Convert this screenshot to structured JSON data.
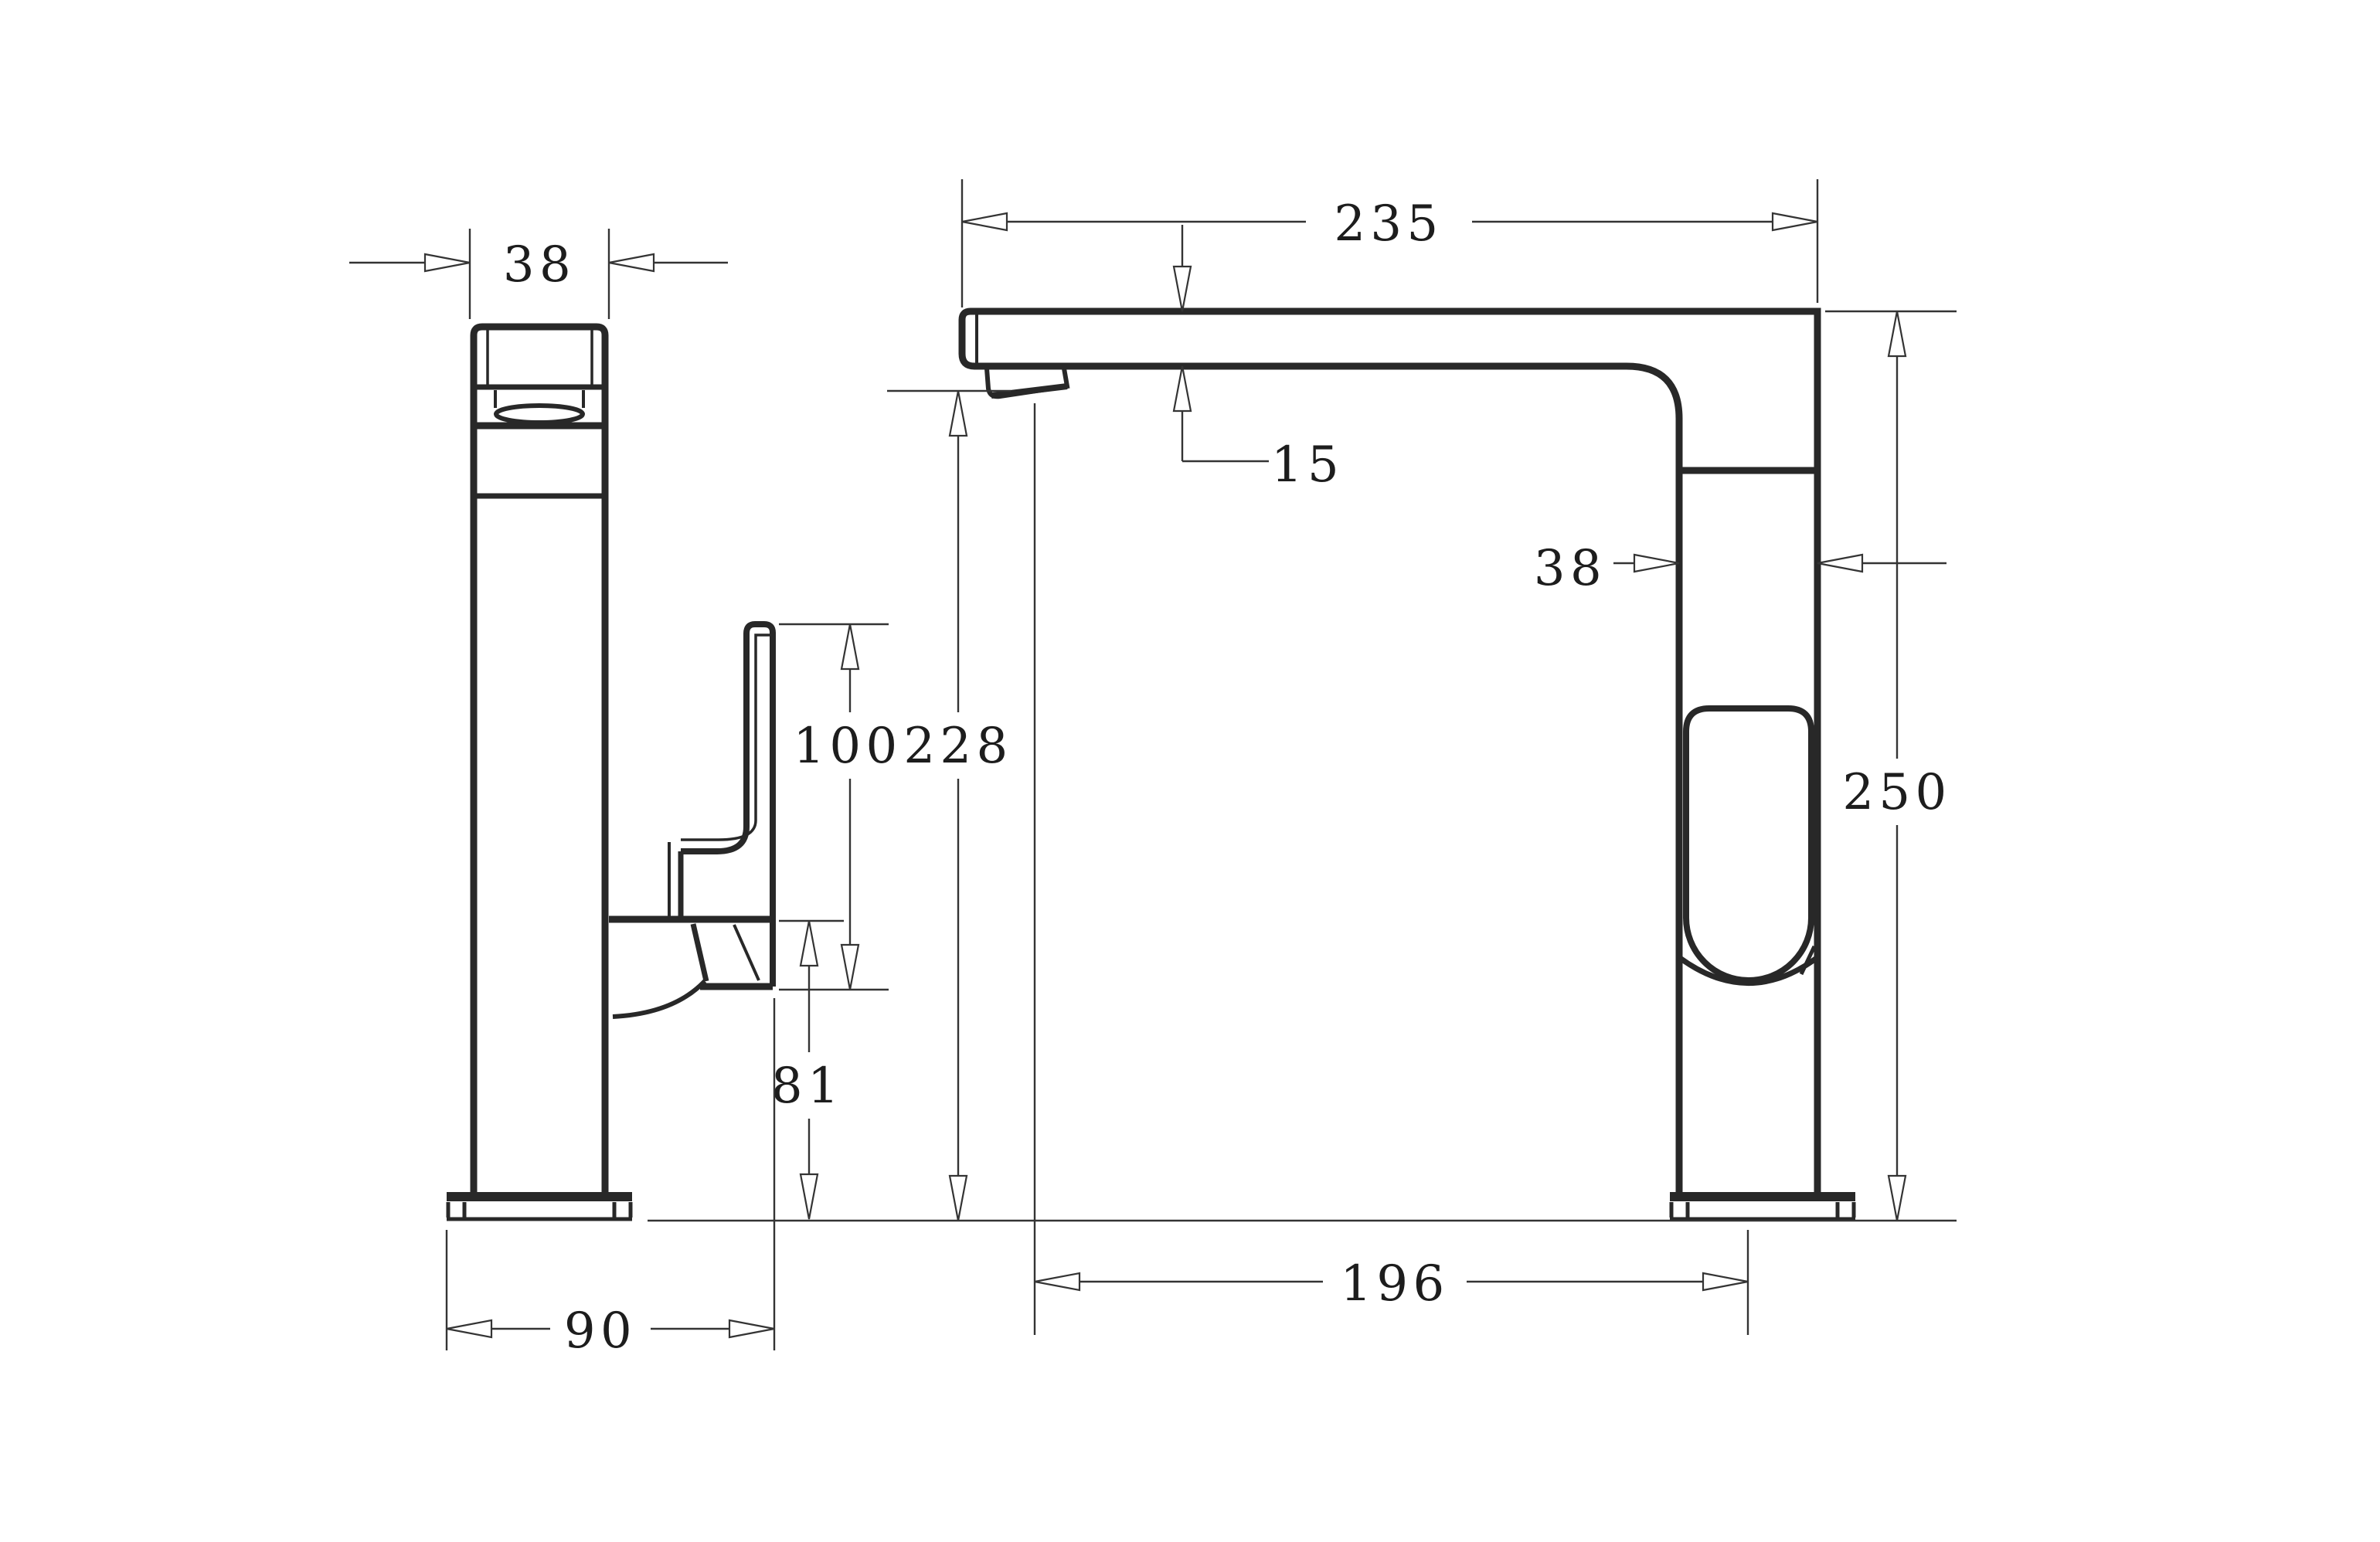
{
  "drawing": {
    "type": "technical-dimension-drawing",
    "subject": "kitchen-sink-mixer-faucet-two-views",
    "line_color": "#282828",
    "background": "#ffffff",
    "side_view": {
      "head_width": "38",
      "overall_depth": "90",
      "handle_length": "100",
      "handle_base_to_bench": "81"
    },
    "front_view": {
      "spout_overall_reach": "235",
      "spout_thickness": "15",
      "body_width": "38",
      "outlet_height": "228",
      "overall_height": "250",
      "outlet_reach": "196"
    }
  }
}
